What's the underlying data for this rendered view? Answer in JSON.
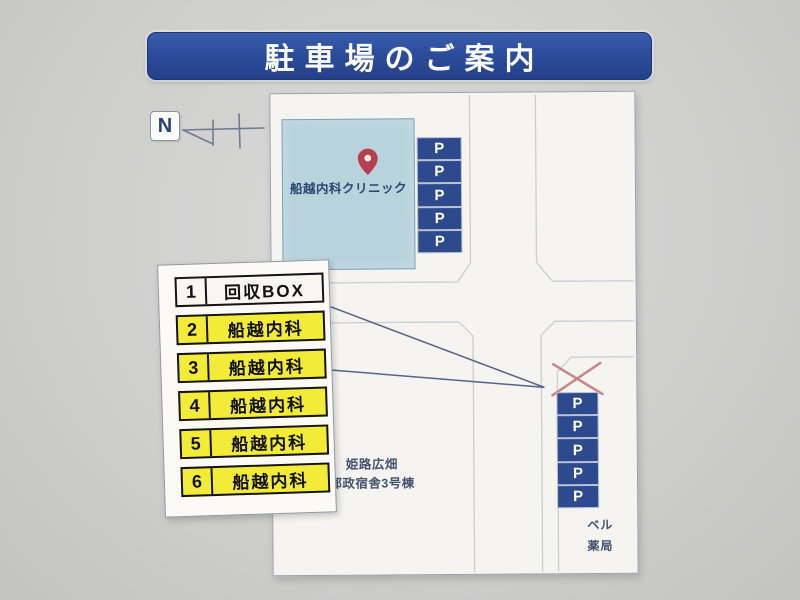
{
  "sign": {
    "title": "駐車場のご案内",
    "compass": {
      "label": "N"
    },
    "map": {
      "clinic": {
        "name": "船越内科クリニック"
      },
      "building_labels": {
        "dormitory": [
          "姫路広畑",
          "郵政宿舎3号棟"
        ],
        "pharmacy": [
          "ベル",
          "薬局"
        ]
      },
      "parking": {
        "symbol": "P",
        "top_column_spaces": 5,
        "bottom_column_spaces": 5
      }
    },
    "legend": {
      "rows": [
        {
          "number": "1",
          "label": "回収BOX",
          "highlight": false
        },
        {
          "number": "2",
          "label": "船越内科",
          "highlight": true
        },
        {
          "number": "3",
          "label": "船越内科",
          "highlight": true
        },
        {
          "number": "4",
          "label": "船越内科",
          "highlight": true
        },
        {
          "number": "5",
          "label": "船越内科",
          "highlight": true
        },
        {
          "number": "6",
          "label": "船越内科",
          "highlight": true
        }
      ]
    },
    "colors": {
      "banner_blue": "#2c4d9b",
      "parking_blue": "#2d4a8e",
      "highlight_yellow": "#f2ec38",
      "building_blue": "#b9d3dd",
      "pin_red": "#b8404e",
      "cross_red": "#c4737c",
      "road_gray": "#cacdd5",
      "pointer_blue": "#55628a"
    }
  }
}
